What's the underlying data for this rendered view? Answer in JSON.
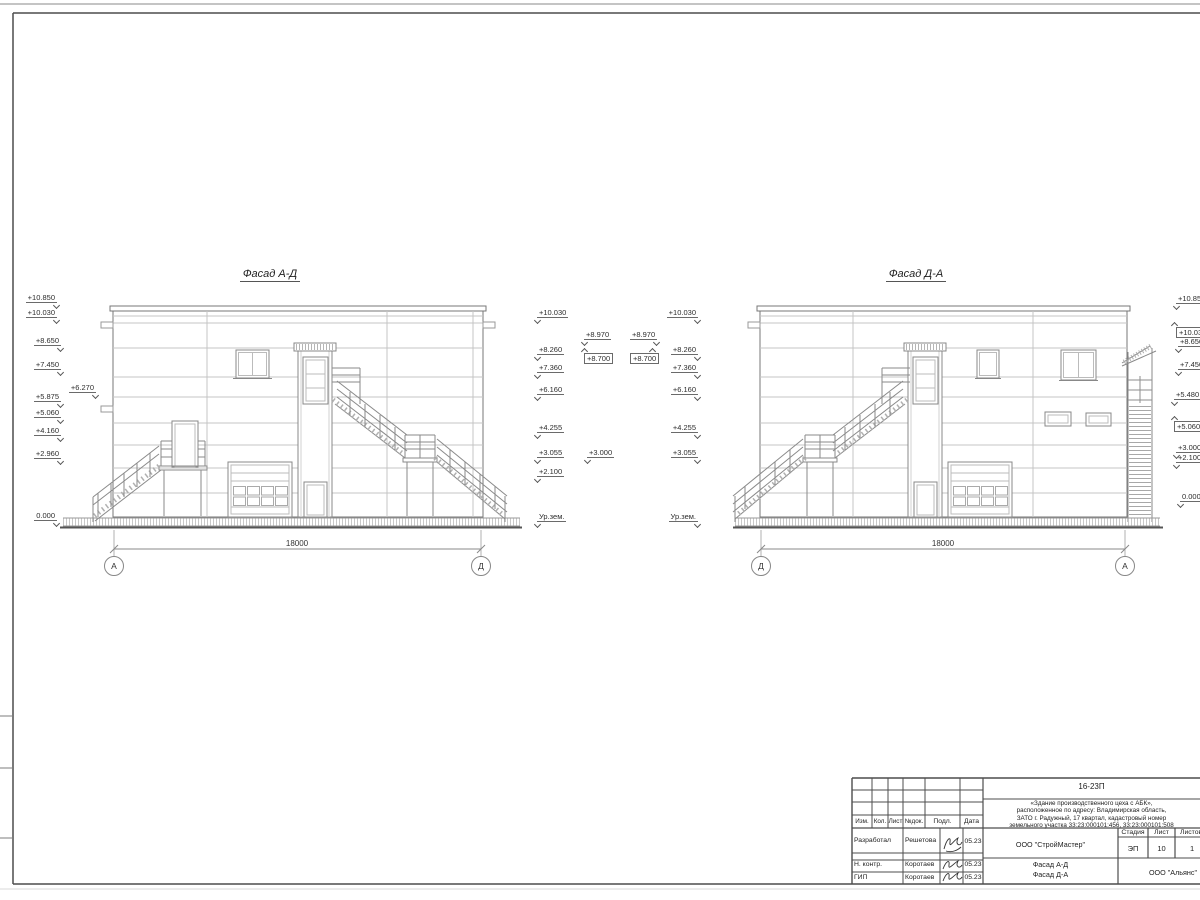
{
  "drawing": {
    "facadeAD": {
      "title": "Фасад А-Д",
      "dim": "18000",
      "axisL": "А",
      "axisR": "Д"
    },
    "facadeDA": {
      "title": "Фасад Д-А",
      "dim": "18000",
      "axisL": "Д",
      "axisR": "А"
    },
    "farLeft": [
      "+10.850",
      "+10.030",
      "+8.650",
      "+7.450",
      "+6.270",
      "+5.875",
      "+5.060",
      "+4.160",
      "+2.960",
      "0.000"
    ],
    "midLeft": [
      "+10.030",
      "+8.260",
      "+7.360",
      "+6.160",
      "+4.255",
      "+3.055",
      "+2.100",
      "Ур.зем."
    ],
    "midRight": [
      "+10.030",
      "+8.260",
      "+7.360",
      "+6.160",
      "+4.255",
      "+3.055",
      "Ур.зем."
    ],
    "farRight": [
      "+10.850",
      "+10.030",
      "+8.650",
      "+7.450",
      "+5.480",
      "+5.060",
      "+3.000",
      "+2.100",
      "0.000"
    ],
    "canopyTop": "+8.970",
    "canopyBottom": "+8.700",
    "landingMark": "+3.000"
  },
  "titleblock": {
    "code": "16-23П",
    "description": {
      "line1": "«Здание производственного цеха с АБК»,",
      "line2": "расположенное по адресу: Владимирская область,",
      "line3": "ЗАТО г. Радужный, 17 квартал, кадастровый номер",
      "line4": "земельного участка 33:23:000101:456, 33:23:000101:508"
    },
    "columns": {
      "c1": "Изм.",
      "c2": "Кол.",
      "c3": "Лист",
      "c4": "№док.",
      "c5": "Подл.",
      "c6": "Дата"
    },
    "rows": [
      {
        "role": "Разработал",
        "name": "Решетова",
        "date": "05.23"
      },
      {
        "role": "Н. контр.",
        "name": "Коротаев",
        "date": "05.23"
      },
      {
        "role": "ГИП",
        "name": "Коротаев",
        "date": "05.23"
      }
    ],
    "contractor": "ООО \"СтройМастер\"",
    "stage": {
      "h1": "Стадия",
      "h2": "Лист",
      "h3": "Листов",
      "v1": "ЭП",
      "v2": "10",
      "v3": "1"
    },
    "subject1": "Фасад А-Д",
    "subject2": "Фасад Д-А",
    "designer": "ООО \"Альянс\""
  }
}
